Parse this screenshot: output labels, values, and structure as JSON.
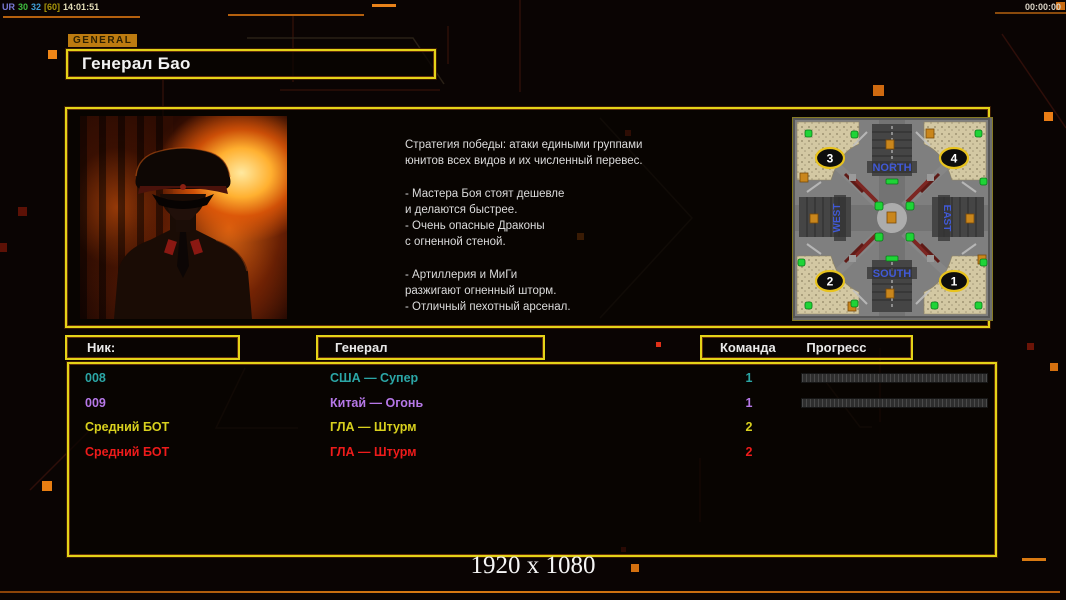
{
  "hud": {
    "stats": {
      "tag": "UR",
      "fps": "30",
      "val": "32",
      "cap": "[60]",
      "clock": "14:01:51"
    },
    "match_timer": "00:00:00",
    "resolution_label": "1920 x 1080"
  },
  "header": {
    "tab_label": "GENERAL",
    "title": "Генерал Бао"
  },
  "general_info": {
    "strategy": "Стратегия победы: атаки едиными группами\nюнитов всех видов и их численный перевес.\n\n- Мастера Боя стоят дешевле\nи делаются быстрее.\n- Очень опасные Драконы\nс огненной стеной.\n\n- Артиллерия и МиГи\nразжигают огненный шторм.\n- Отличный пехотный арсенал."
  },
  "map": {
    "north": "NORTH",
    "south": "SOUTH",
    "west": "WEST",
    "east": "EAST",
    "spawn_1": "1",
    "spawn_2": "2",
    "spawn_3": "3",
    "spawn_4": "4"
  },
  "players": {
    "headers": {
      "nick": "Ник:",
      "general": "Генерал",
      "team": "Команда",
      "progress": "Прогресс"
    },
    "rows": [
      {
        "nick": "008",
        "general": "США — Супер",
        "team": "1",
        "color": "#2ba6a6",
        "loading": true
      },
      {
        "nick": "009",
        "general": "Китай — Огонь",
        "team": "1",
        "color": "#b678e8",
        "loading": true
      },
      {
        "nick": "Средний БОТ",
        "general": "ГЛА — Штурм",
        "team": "2",
        "color": "#d8d01e",
        "loading": false
      },
      {
        "nick": "Средний БОТ",
        "general": "ГЛА — Штурм",
        "team": "2",
        "color": "#ee1b1b",
        "loading": false
      }
    ]
  },
  "colors": {
    "accent_border": "#e4d318",
    "hud_orange": "#c96a10",
    "stats_tag": "#7b7bd8",
    "stats_fps": "#3fbf3f",
    "stats_val": "#3f9fd8",
    "stats_cap": "#a8960a",
    "stats_clock": "#e4ddb8"
  }
}
